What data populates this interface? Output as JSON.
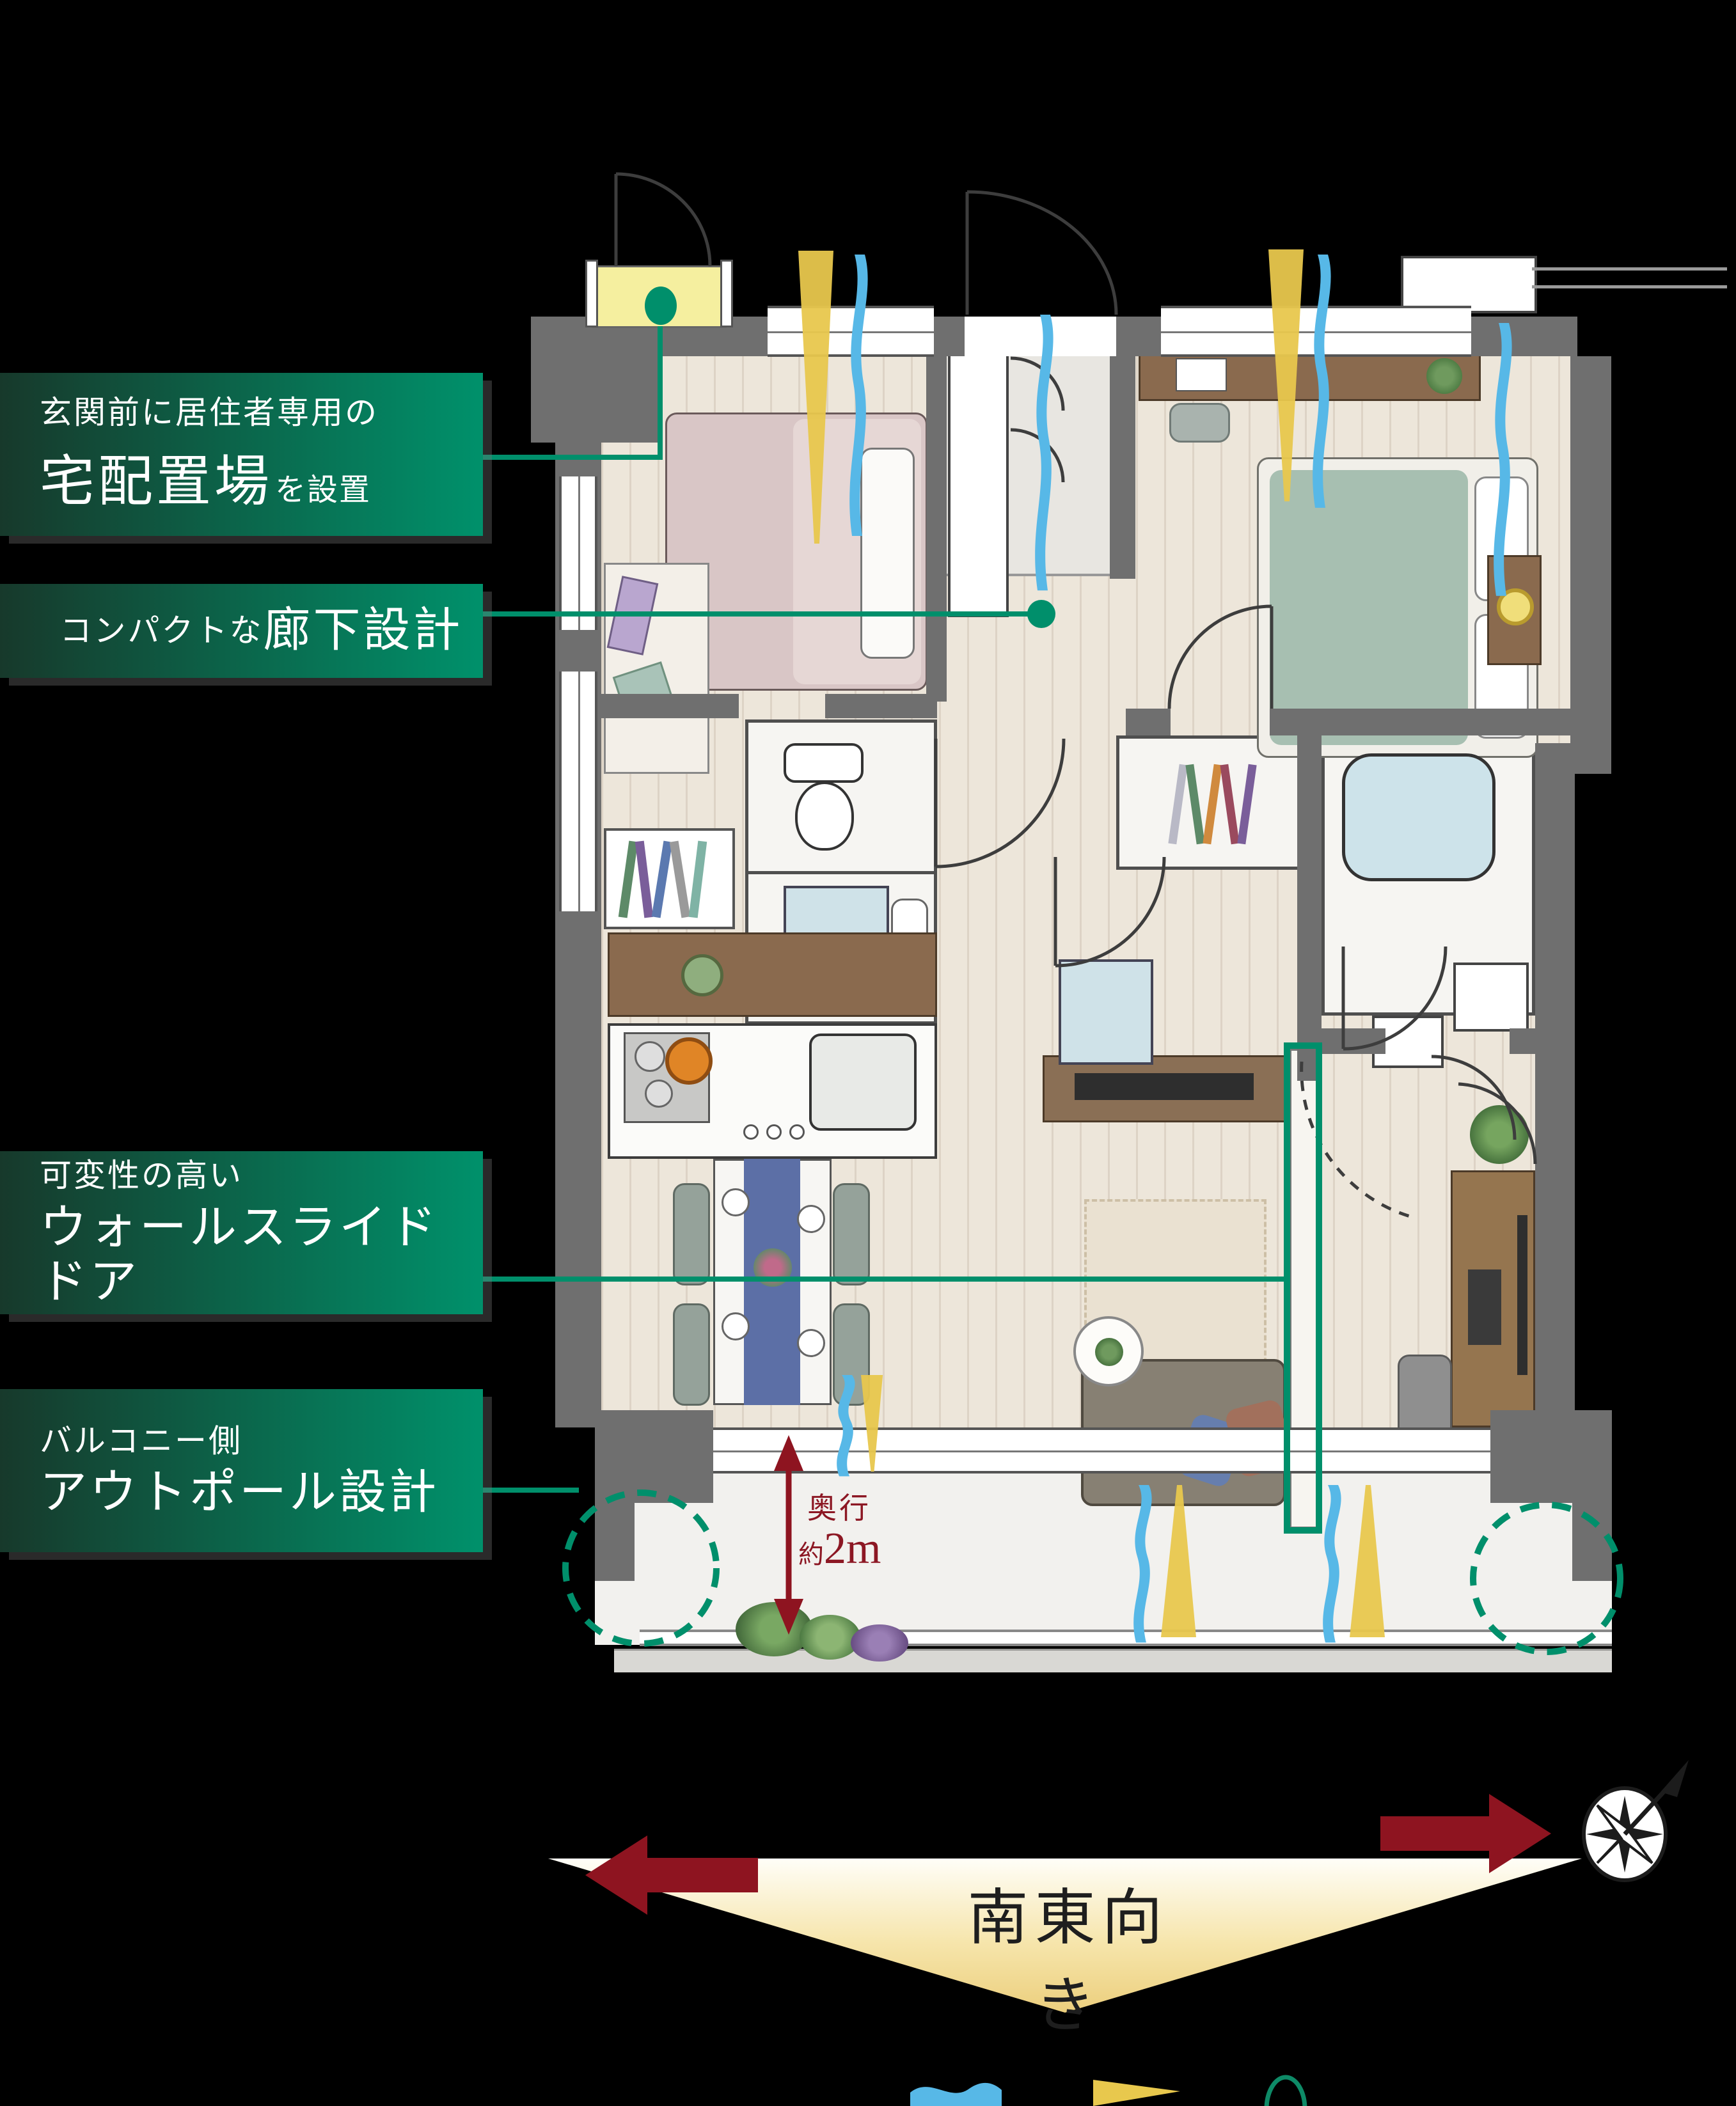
{
  "page": {
    "background_color": "#000000",
    "type": "floor-plan-infographic"
  },
  "annotations": {
    "labels": [
      {
        "id": "delivery-spot",
        "line1": "玄関前に居住者専用の",
        "emphasis": "宅配置場",
        "suffix": "を設置"
      },
      {
        "id": "compact-corridor",
        "prefix": "コンパクトな",
        "emphasis": "廊下設計"
      },
      {
        "id": "wall-slide-door",
        "line1": "可変性の高い",
        "emphasis": "ウォールスライドドア"
      },
      {
        "id": "out-pole",
        "line1": "バルコニー側",
        "emphasis": "アウトポール設計"
      }
    ],
    "balcony_depth": {
      "label": "奥行",
      "approx": "約",
      "value": "2m"
    },
    "direction": {
      "text": "南東向き"
    }
  },
  "icons": {
    "wind": "blue-wave-icon",
    "light": "yellow-beam-icon",
    "compass": "compass-rose-icon",
    "direction_arrows": "red-direction-arrows",
    "delivery_highlight": "yellow-highlight-area",
    "outpole_highlight": "teal-dashed-circle",
    "wallslide_highlight": "teal-outline-rect"
  },
  "colors": {
    "label_gradient_left": "#17392b",
    "label_gradient_right": "#00916b",
    "callout_teal": "#008f6b",
    "wall_gray": "#6f6f6f",
    "delivery_yellow": "#f5ef9f",
    "arrow_red": "#8e1420",
    "depth_text_red": "#8c1723",
    "direction_triangle": "#f0d98a",
    "wind_blue": "#57b8e7",
    "light_yellow": "#e8c84d",
    "bathtub_blue": "#cde3ea"
  }
}
